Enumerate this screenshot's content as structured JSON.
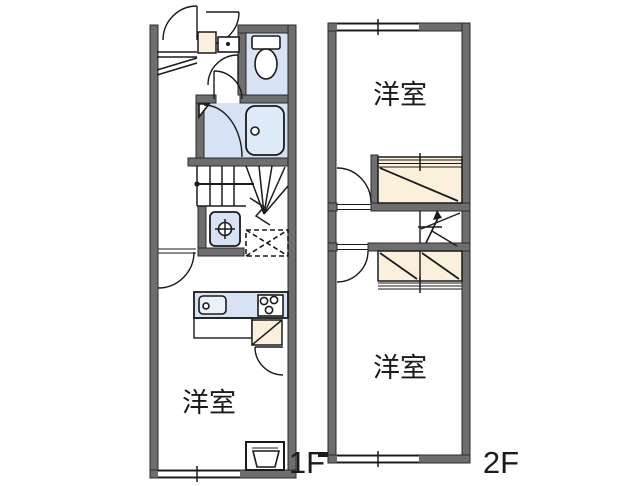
{
  "page": {
    "background": "#ffffff",
    "type": "apartment-floor-plan"
  },
  "colors": {
    "wall_gray": "#6e6e6e",
    "wall_outline": "#2b2b2b",
    "water_fixture_blue": "#d7e3f4",
    "bathtub_blue": "#dfeaf8",
    "closet_cream": "#faf0dc",
    "line_black": "#1a1a1a"
  },
  "floors": {
    "f1": {
      "floor_label": "1F",
      "room_label": "洋室",
      "fixtures": [
        "entrance-door",
        "shoe-cabinet",
        "washbasin-cabinet",
        "toilet",
        "bathroom-door",
        "bathtub",
        "staircase",
        "handrail",
        "washing-machine-pan",
        "refrigerator-space",
        "hall-door",
        "kitchen-sink",
        "gas-stove",
        "kitchen-counter",
        "kitchen-closet",
        "closet-door",
        "water-heater",
        "window"
      ]
    },
    "f2": {
      "floor_label": "2F",
      "room_label_top": "洋室",
      "room_label_bottom": "洋室",
      "fixtures": [
        "window-top",
        "room-door-upper",
        "closet-upper",
        "staircase-arrow",
        "room-door-lower",
        "closet-lower",
        "window-bottom"
      ]
    }
  }
}
